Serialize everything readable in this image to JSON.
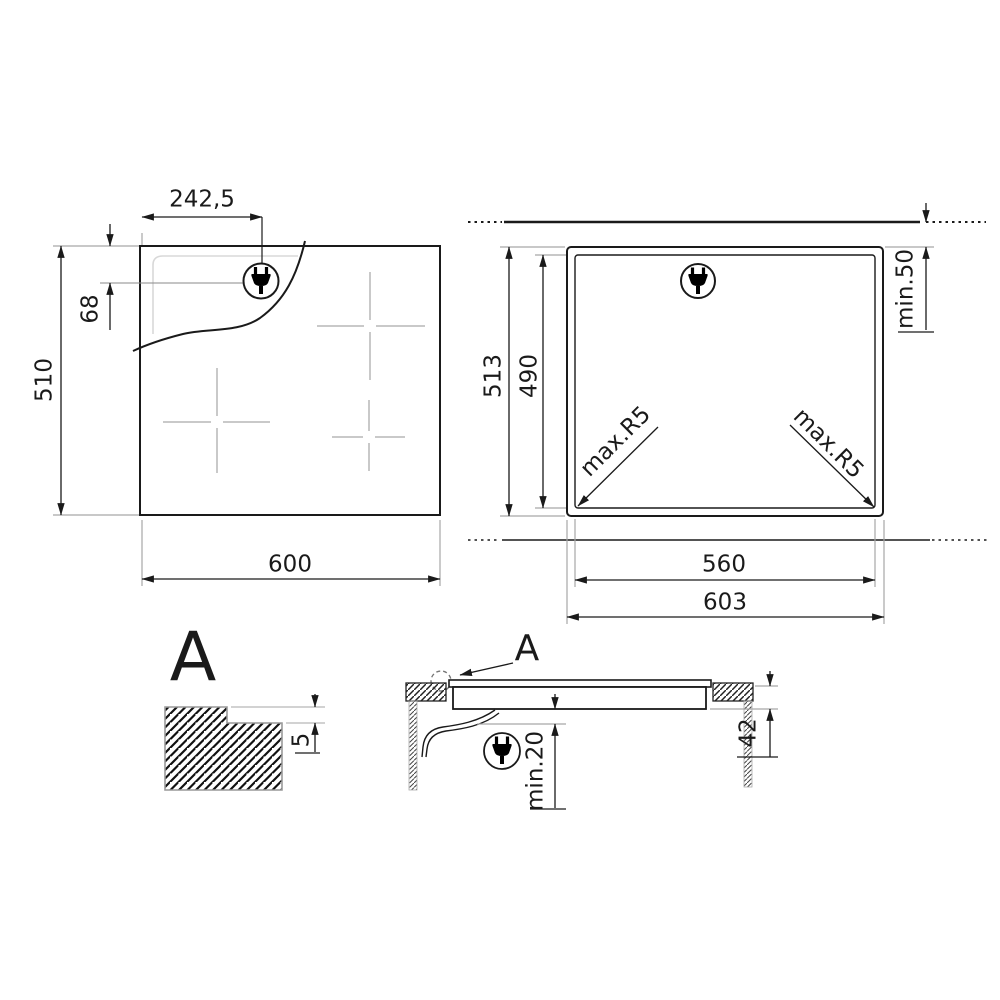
{
  "plan": {
    "dim_plug_x": "242,5",
    "dim_plug_y": "68",
    "dim_height": "510",
    "dim_width": "600"
  },
  "cutout": {
    "dim_total_height": "513",
    "dim_cutout_height": "490",
    "dim_wall_clearance": "min.50",
    "dim_corner_radius_left": "max.R5",
    "dim_corner_radius_right": "max.R5",
    "dim_cutout_width": "560",
    "dim_total_width": "603"
  },
  "detail": {
    "label": "A",
    "dim_profile_height": "5"
  },
  "section": {
    "label": "A",
    "dim_clearance_below": "min.20",
    "dim_body_depth": "42"
  },
  "icons": {
    "power_plug": "power-plug-icon"
  },
  "colors": {
    "line": "#1a1a1a",
    "extension": "#a6a6a6",
    "faint": "#d8d8d8",
    "zone_cross": "#c9c9c9"
  }
}
